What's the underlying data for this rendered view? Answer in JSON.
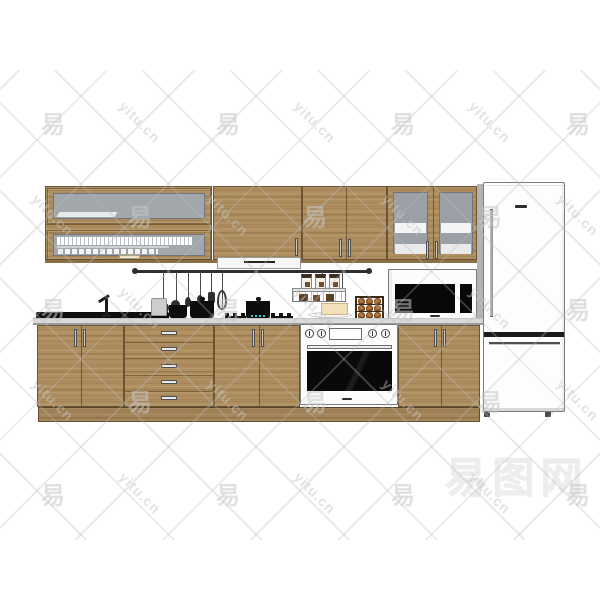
{
  "watermark": {
    "tile_glyph": "易",
    "tile_text": "yitu.cn",
    "big_text": "易图网",
    "grid_cols": [
      53,
      140,
      228,
      315,
      403,
      490,
      578
    ],
    "grid_rows": [
      122,
      215,
      308,
      400,
      493
    ]
  },
  "colors": {
    "background": "#ffffff",
    "wood": "#ae8e5f",
    "wood_dark": "#6a5433",
    "counter": "#dadada",
    "counter_edge": "#9b9b9b",
    "glass": "#a2a7ac",
    "glass_right": "#9aa0a6",
    "appliance_white": "#fcfcfc",
    "appliance_outline": "#7c7c7c",
    "black": "#0d0d0d",
    "steel": "#d6d6d6",
    "hood_white": "#f6f6f6",
    "bread": "#b06f33",
    "bread_dark": "#6f4418",
    "cheese": "#f1e0ba",
    "flame": "#38c4d4",
    "watermark_gray": "#c6c6c6"
  }
}
